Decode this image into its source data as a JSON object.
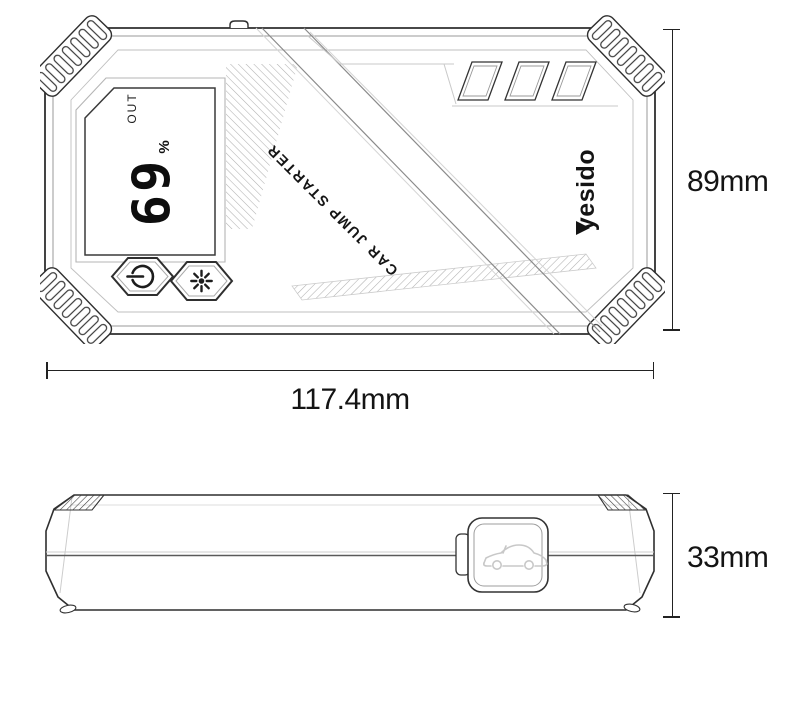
{
  "device": {
    "brand": "yesido",
    "product_label": "CAR JUMP STARTER",
    "display": {
      "out_indicator": "OUT",
      "battery_value": "69",
      "unit": "%"
    }
  },
  "dimensions": {
    "height": "89mm",
    "width": "117.4mm",
    "thickness": "33mm"
  },
  "icons": {
    "power_button": "power-icon",
    "light_button": "light-icon",
    "jump_port_cover": "car-icon"
  },
  "colors": {
    "background": "#ffffff",
    "line_art": "#2f2f2f",
    "dimension_text": "#141414",
    "car_icon_stroke": "#c8c8c8"
  }
}
